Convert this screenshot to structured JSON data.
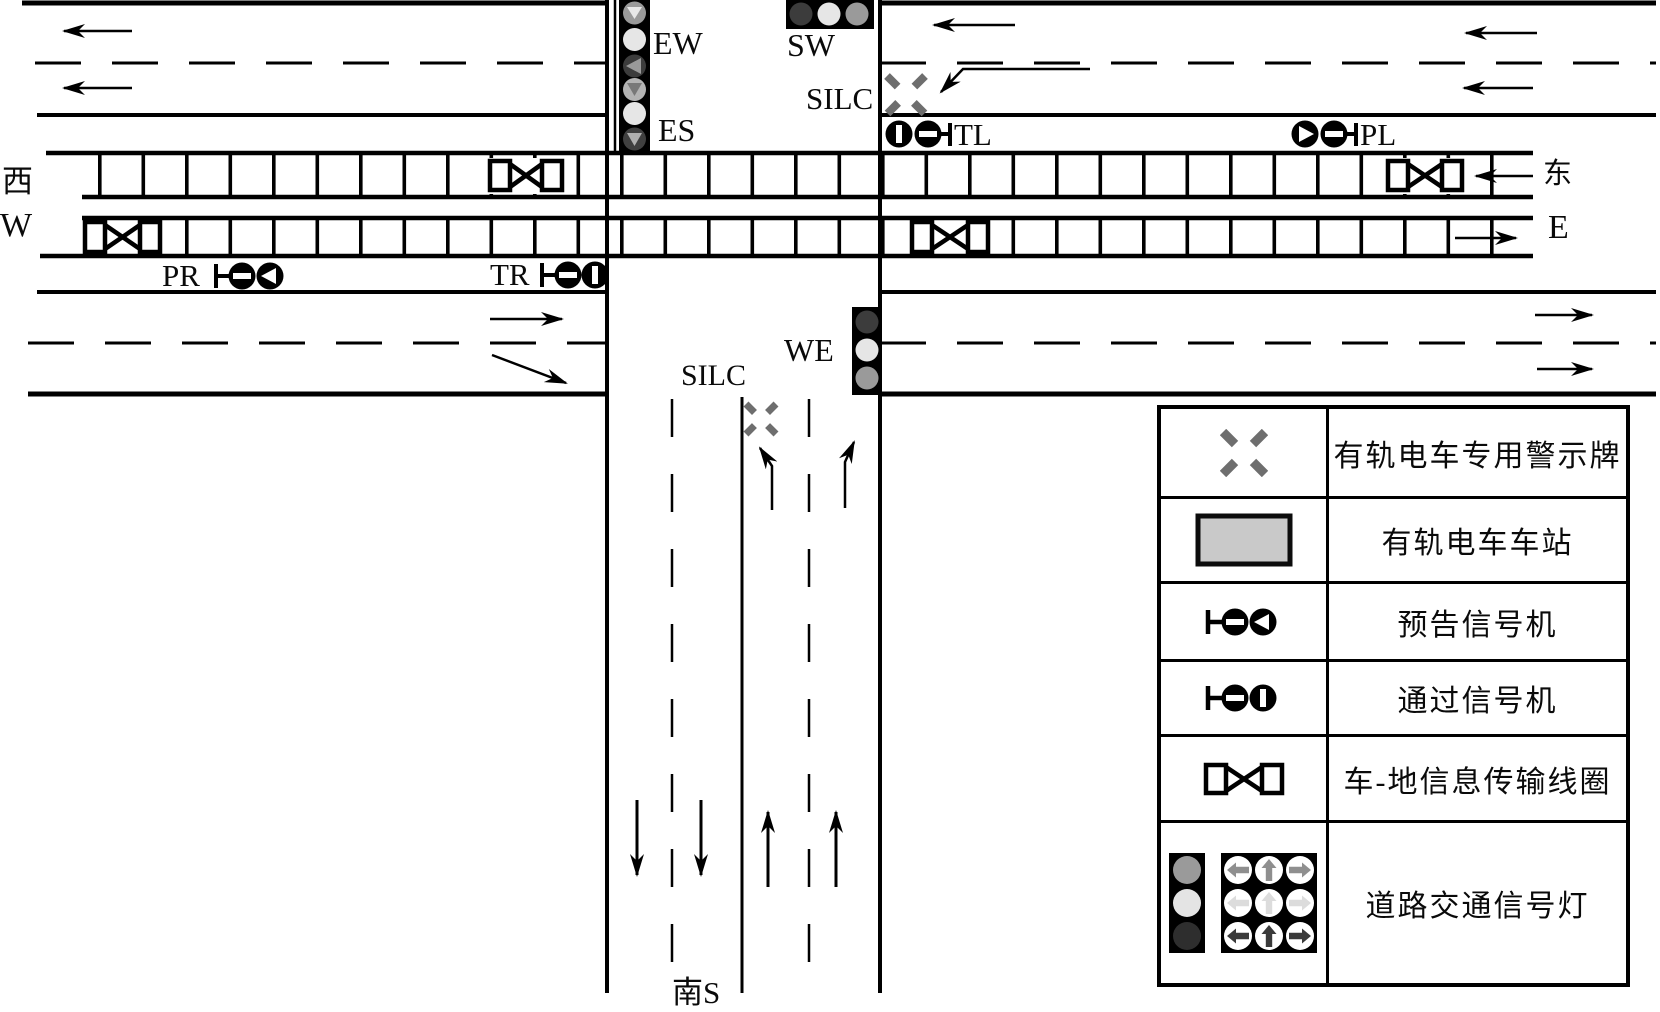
{
  "figure": {
    "title": "tram intersection signal layout diagram",
    "type": "schematic"
  },
  "compass": {
    "west_cn": "西",
    "west_en": "W",
    "east_cn": "东",
    "east_en": "E",
    "south": "南S"
  },
  "signal_labels": {
    "ew": "EW",
    "es": "ES",
    "sw": "SW",
    "we": "WE",
    "tl": "TL",
    "pl": "PL",
    "pr": "PR",
    "tr": "TR",
    "silc_north": "SILC",
    "silc_south": "SILC"
  },
  "legend": {
    "rows": [
      {
        "symbol": "tram-warning-sign",
        "label": "有轨电车专用警示牌"
      },
      {
        "symbol": "tram-station",
        "label": "有轨电车车站"
      },
      {
        "symbol": "advance-signal",
        "label": "预告信号机"
      },
      {
        "symbol": "passing-signal",
        "label": "通过信号机"
      },
      {
        "symbol": "train-ground-loop",
        "label": "车-地信息传输线圈"
      },
      {
        "symbol": "road-traffic-light",
        "label": "道路交通信号灯"
      }
    ]
  },
  "colors": {
    "line": "#000000",
    "lamp_light": "#e6e6e6",
    "lamp_medium": "#9a9a9a",
    "lamp_dark": "#3a3a3a",
    "warning_sign": "#6e6e6e",
    "station_fill": "#c9c9c9"
  }
}
